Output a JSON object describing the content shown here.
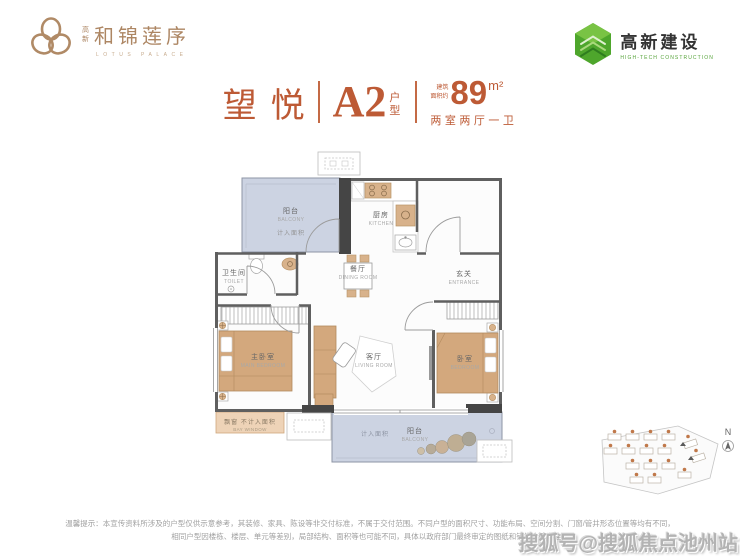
{
  "brand_left": {
    "prefix": "高新",
    "name": "和锦莲序",
    "subtitle": "LOTUS PALACE"
  },
  "brand_right": {
    "name": "高新建设",
    "subtitle": "HIGH-TECH CONSTRUCTION"
  },
  "title": {
    "project": "望悦",
    "unit": "A2",
    "unit_type": "户型",
    "area_prefix_top": "建筑",
    "area_prefix_bottom": "面积约",
    "area_value": "89",
    "area_unit": "m²",
    "layout": "两室两厅一卫"
  },
  "floorplan": {
    "rooms": [
      {
        "zh": "阳台",
        "en": "BALCONY",
        "note": "计入面积"
      },
      {
        "zh": "厨房",
        "en": "KITCHEN"
      },
      {
        "zh": "卫生间",
        "en": "TOILET"
      },
      {
        "zh": "餐厅",
        "en": "DINING ROOM"
      },
      {
        "zh": "玄关",
        "en": "ENTRANCE"
      },
      {
        "zh": "主卧室",
        "en": "MAIN BEDROOM"
      },
      {
        "zh": "客厅",
        "en": "LIVING ROOM"
      },
      {
        "zh": "卧室",
        "en": "BEDROOM"
      },
      {
        "zh": "飘窗 不计入面积",
        "en": "BAY WINDOW"
      },
      {
        "zh": "计入面积"
      },
      {
        "zh": "阳台",
        "en": "BALCONY"
      }
    ]
  },
  "site_plan": {
    "north_label": "N"
  },
  "disclaimer": {
    "line1": "温馨提示：本宣传资料所涉及的户型仅供示意参考，其装修、家具、陈设等非交付标准，不属于交付范围。不同户型的面积尺寸、功能布局、空间分割、门窗/管井形态位置等均有不同，",
    "line2": "相同户型因楼栋、楼层、单元等差别，局部结构、面积等也可能不同，具体以政府部门最终审定的图纸和销售合同为准。"
  },
  "watermark": "搜狐号@搜狐焦点池州站",
  "colors": {
    "accent": "#bd5a35",
    "brand": "#ad8663",
    "green": "#4ea62c",
    "balcony_fill": "#ccd3e2",
    "furniture": "#d3a87d",
    "wall": "#5f5f5f"
  }
}
